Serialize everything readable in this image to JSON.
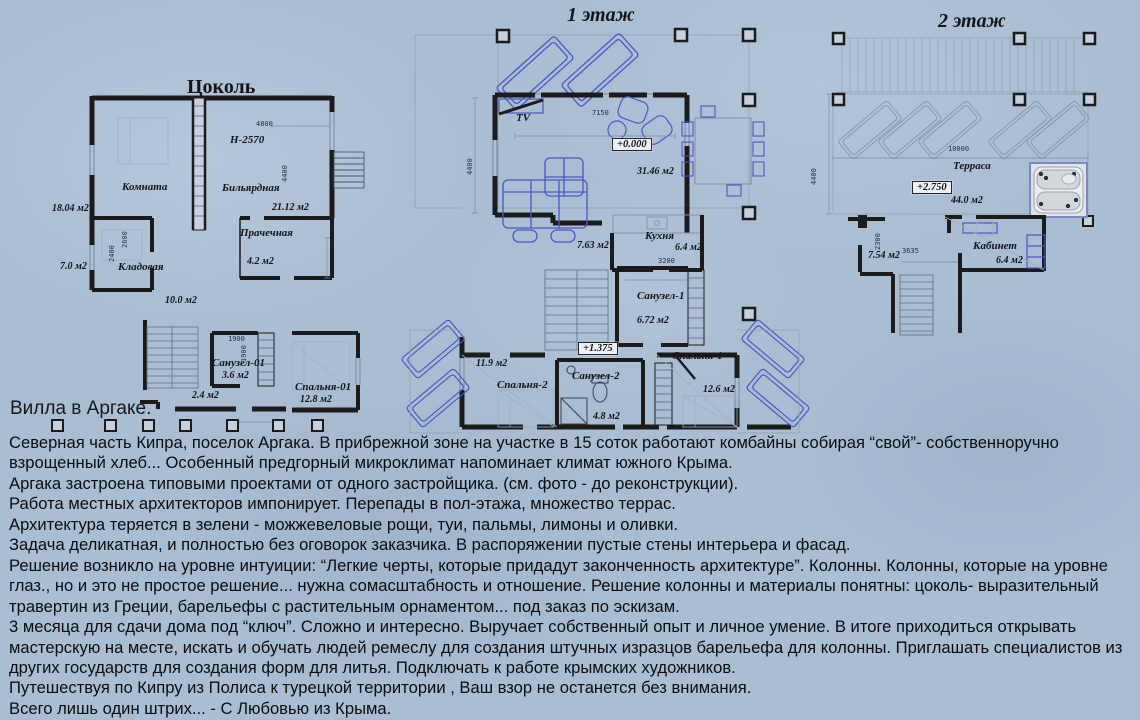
{
  "caption": "Вилла в Аргаке.",
  "body_lines": [
    "Северная часть Кипра, поселок Аргака.  В прибрежной зоне на участке в 15 соток работают комбайны собирая “свой”- собственноручно",
    "взрощенный хлеб...   Особенный предгорный микроклимат напоминает климат южного Крыма.",
    "Аргака застроена типовыми проектами от одного застройщика. (см. фото - до реконструкции).",
    "Работа местных архитекторов импонирует. Перепады в пол-этажа, множество террас.",
    "Архитектура теряется в зелени - можжевеловые рощи, туи, пальмы, лимоны и оливки.",
    "Задача деликатная, и полностью без оговорок заказчика. В распоряжении пустые стены интерьера и фасад.",
    "Решение возникло на уровне интуиции: “Легкие черты, которые придадут законченность архитектуре”. Колонны. Колонны, которые на уровне",
    "глаз., но и это не простое решение... нужна сомасштабность и отношение.  Решение колонны и материалы понятны: цоколь- выразительный",
    "травертин из Греции, барельефы с растительным орнаментом... под заказ по эскизам.",
    "3 месяца для сдачи дома под “ключ”. Сложно и интересно. Выручает собственный опыт и личное умение. В итоге приходиться открывать",
    "мастерскую на месте, искать и обучать людей ремеслу для создания штучных изразцов барельефа для колонны. Приглашать специалистов из",
    "других государств для создания форм для литья. Подключать к работе крымских художников.",
    "Путешествуя по Кипру из Полиса к турецкой территории , Ваш взор не останется без внимания.",
    "Всего лишь один штрих...  - С Любовью из Крыма."
  ],
  "basement": {
    "title": "Цоколь",
    "mark": "Н-2570",
    "dim_w": "4800",
    "dim_h": "4400",
    "dim_k1": "2600",
    "dim_k2": "2400",
    "dim_s1": "1900",
    "dim_s2": "1900",
    "komnata": "Комната",
    "komnata_area": "18.04 м2",
    "bilyard": "Бильярдная",
    "bilyard_area": "21.12 м2",
    "prachechnaya": "Прачечная",
    "prachechnaya_area": "4.2 м2",
    "kladovaya": "Кладовая",
    "kladovaya_area": "7.0 м2",
    "hall_area": "10.0 м2",
    "sanuzel": "Санузел-01",
    "sanuzel_area": "3.6 м2",
    "spalnya": "Спальня-01",
    "spalnya_area": "12.8 м2",
    "tambur_area": "2.4 м2"
  },
  "floor1": {
    "title": "1 этаж",
    "tv": "TV",
    "dim_w": "7150",
    "dim_h": "4400",
    "dim_kitchen": "3200",
    "elev_main": "+0.000",
    "elev_upper": "+1.375",
    "living_area": "31.46 м2",
    "hall_area": "7.63 м2",
    "kitchen": "Кухня",
    "kitchen_area": "6.4 м2",
    "sanuzel1": "Санузел-1",
    "sanuzel1_area": "6.72 м2",
    "terrace_area": "11.9 м2",
    "spalnya2": "Спальня-2",
    "sanuzel2": "Санузел-2",
    "sanuzel2_area": "4.8 м2",
    "spalnya1": "Спальня-1",
    "spalnya1_area": "12.6 м2"
  },
  "floor2": {
    "title": "2 этаж",
    "dim_w": "10000",
    "dim_h": "4400",
    "dim_hall": "3635",
    "dim_hall_v": "2300",
    "terrace": "Терраса",
    "elev": "+2.750",
    "terrace_area": "44.0 м2",
    "hall_area": "7.54 м2",
    "kabinet": "Кабинет",
    "kabinet_area": "6.4 м2"
  },
  "colors": {
    "background": "#a9bdd3",
    "ink": "#1b1b1b",
    "furniture_blue": "#4d57c2"
  }
}
